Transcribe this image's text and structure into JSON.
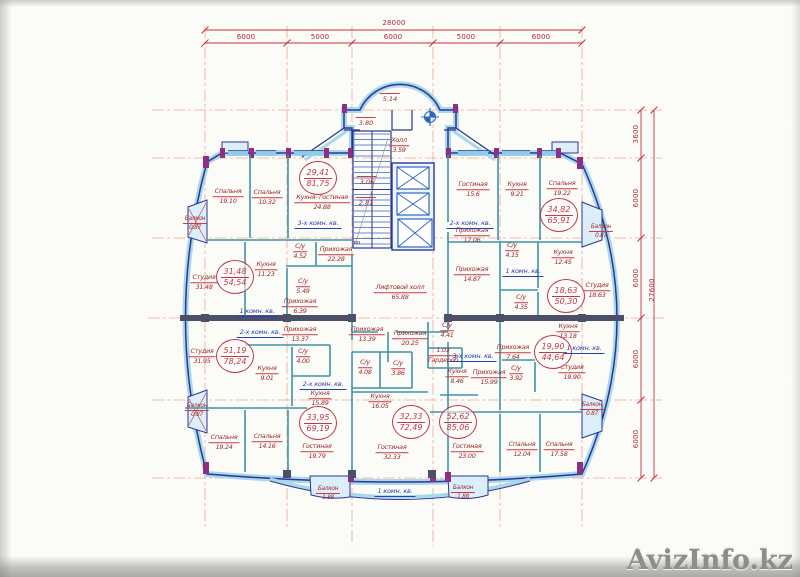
{
  "watermark": "AvizInfo.kz",
  "dimensions": {
    "top_total": {
      "text": "28000",
      "x": 394,
      "y": 23
    },
    "top_segments": [
      {
        "text": "6000",
        "x": 246,
        "y": 37
      },
      {
        "text": "5000",
        "x": 320,
        "y": 37
      },
      {
        "text": "6000",
        "x": 393,
        "y": 37
      },
      {
        "text": "5000",
        "x": 466,
        "y": 37
      },
      {
        "text": "6000",
        "x": 541,
        "y": 37
      }
    ],
    "right_total": {
      "text": "27600",
      "x": 652,
      "y": 290
    },
    "right_segments": [
      {
        "text": "3600",
        "x": 636,
        "y": 134
      },
      {
        "text": "6000",
        "x": 636,
        "y": 198
      },
      {
        "text": "6000",
        "x": 636,
        "y": 278
      },
      {
        "text": "6000",
        "x": 636,
        "y": 359
      },
      {
        "text": "6000",
        "x": 636,
        "y": 439
      }
    ]
  },
  "apartments": [
    {
      "living": "29,41",
      "total": "81,75",
      "x": 318,
      "y": 178
    },
    {
      "living": "31,48",
      "total": "54,54",
      "x": 235,
      "y": 277
    },
    {
      "living": "51,19",
      "total": "78,24",
      "x": 235,
      "y": 356
    },
    {
      "living": "33,95",
      "total": "69,19",
      "x": 318,
      "y": 423
    },
    {
      "living": "32,33",
      "total": "72,49",
      "x": 411,
      "y": 422
    },
    {
      "living": "52,62",
      "total": "85,06",
      "x": 458,
      "y": 422
    },
    {
      "living": "19,90",
      "total": "44,64",
      "x": 553,
      "y": 352
    },
    {
      "living": "18,63",
      "total": "50,30",
      "x": 566,
      "y": 296
    },
    {
      "living": "34,82",
      "total": "65,91",
      "x": 559,
      "y": 215
    }
  ],
  "unit_types": [
    {
      "label": "3-х комн. кв.",
      "x": 318,
      "y": 224
    },
    {
      "label": "1 комн. кв.",
      "x": 257,
      "y": 312
    },
    {
      "label": "2-х комн. кв.",
      "x": 260,
      "y": 333
    },
    {
      "label": "2-х комн. кв.",
      "x": 323,
      "y": 385
    },
    {
      "label": "1 комн. кв.",
      "x": 395,
      "y": 492
    },
    {
      "label": "3-х комн. кв.",
      "x": 473,
      "y": 357
    },
    {
      "label": "1 комн. кв.",
      "x": 584,
      "y": 349
    },
    {
      "label": "1 комн. кв.",
      "x": 523,
      "y": 272
    },
    {
      "label": "2-х комн. кв.",
      "x": 470,
      "y": 224
    }
  ],
  "stair_numbers": [
    {
      "value": "5.14",
      "x": 390,
      "y": 98
    },
    {
      "value": "3.80",
      "x": 366,
      "y": 122
    },
    {
      "value": "3.06",
      "x": 367,
      "y": 181
    },
    {
      "value": "2.81",
      "x": 366,
      "y": 202
    }
  ],
  "misc": [
    {
      "label": "во",
      "x": 357,
      "y": 243
    }
  ],
  "rooms": [
    {
      "name": "Спальня",
      "area": "19.10",
      "x": 228,
      "y": 197
    },
    {
      "name": "Спальня",
      "area": "10.32",
      "x": 267,
      "y": 198
    },
    {
      "name": "Кухня- гостиная",
      "area": "24.88",
      "x": 322,
      "y": 203
    },
    {
      "name": "Балкон",
      "area": "0.87",
      "x": 195,
      "y": 224
    },
    {
      "name": "С/у",
      "area": "4.52",
      "x": 300,
      "y": 252
    },
    {
      "name": "Прихожая",
      "area": "22.28",
      "x": 336,
      "y": 255
    },
    {
      "name": "Студия",
      "area": "31.48",
      "x": 204,
      "y": 283
    },
    {
      "name": "Кухня",
      "area": "11.23",
      "x": 266,
      "y": 270
    },
    {
      "name": "С/у",
      "area": "5.49",
      "x": 303,
      "y": 287
    },
    {
      "name": "Прихожая",
      "area": "6.39",
      "x": 300,
      "y": 307
    },
    {
      "name": "Студия",
      "area": "31.95",
      "x": 202,
      "y": 357
    },
    {
      "name": "Прихожая",
      "area": "13.37",
      "x": 300,
      "y": 335
    },
    {
      "name": "С/у",
      "area": "4.00",
      "x": 303,
      "y": 357
    },
    {
      "name": "Кухня",
      "area": "9.01",
      "x": 267,
      "y": 374
    },
    {
      "name": "Балкон",
      "area": "0.87",
      "x": 197,
      "y": 411
    },
    {
      "name": "Спальня",
      "area": "19.24",
      "x": 224,
      "y": 443
    },
    {
      "name": "Спальня",
      "area": "14.16",
      "x": 267,
      "y": 442
    },
    {
      "name": "Кухня",
      "area": "15.89",
      "x": 320,
      "y": 399
    },
    {
      "name": "Гостиная",
      "area": "19.79",
      "x": 317,
      "y": 452
    },
    {
      "name": "Балкон",
      "area": "1.88",
      "x": 328,
      "y": 494
    },
    {
      "name": "Прихожая",
      "area": "13.39",
      "x": 367,
      "y": 335
    },
    {
      "name": "Прихожая",
      "area": "20.25",
      "x": 410,
      "y": 339
    },
    {
      "name": "С/у",
      "area": "4.08",
      "x": 365,
      "y": 368
    },
    {
      "name": "С/у",
      "area": "3.86",
      "x": 398,
      "y": 369
    },
    {
      "name": "Кухня",
      "area": "16.05",
      "x": 380,
      "y": 402
    },
    {
      "name": "Гостиная",
      "area": "32.33",
      "x": 392,
      "y": 453
    },
    {
      "name": "Балкон",
      "area": "1.88",
      "x": 463,
      "y": 493
    },
    {
      "name": "С/у",
      "area": "4.41",
      "x": 447,
      "y": 331
    },
    {
      "name": "1.03",
      "area": "Гардероб",
      "x": 443,
      "y": 356
    },
    {
      "name": "Кухня",
      "area": "8.46",
      "x": 457,
      "y": 377
    },
    {
      "name": "Прихожая",
      "area": "15.99",
      "x": 489,
      "y": 378
    },
    {
      "name": "С/у",
      "area": "3.92",
      "x": 516,
      "y": 374
    },
    {
      "name": "Гостиная",
      "area": "23.00",
      "x": 467,
      "y": 452
    },
    {
      "name": "Спальня",
      "area": "12.04",
      "x": 522,
      "y": 450
    },
    {
      "name": "Спальня",
      "area": "17.58",
      "x": 559,
      "y": 450
    },
    {
      "name": "Балкон",
      "area": "0.87",
      "x": 592,
      "y": 410
    },
    {
      "name": "Прихожая",
      "area": "7.64",
      "x": 513,
      "y": 353
    },
    {
      "name": "Студия",
      "area": "19.90",
      "x": 572,
      "y": 373
    },
    {
      "name": "Кухня",
      "area": "13.18",
      "x": 568,
      "y": 332
    },
    {
      "name": "С/у",
      "area": "4.35",
      "x": 521,
      "y": 303
    },
    {
      "name": "Прихожая",
      "area": "14.87",
      "x": 472,
      "y": 275
    },
    {
      "name": "С/у",
      "area": "4.15",
      "x": 512,
      "y": 251
    },
    {
      "name": "Студия",
      "area": "18.63",
      "x": 597,
      "y": 291
    },
    {
      "name": "Кухня",
      "area": "12.45",
      "x": 563,
      "y": 258
    },
    {
      "name": "Гостиная",
      "area": "15.6",
      "x": 473,
      "y": 190
    },
    {
      "name": "Кухня",
      "area": "9.21",
      "x": 517,
      "y": 190
    },
    {
      "name": "Спальня",
      "area": "19.22",
      "x": 562,
      "y": 189
    },
    {
      "name": "Прихожая",
      "area": "17.06",
      "x": 472,
      "y": 236
    },
    {
      "name": "Балкон",
      "area": "0.87",
      "x": 601,
      "y": 232
    },
    {
      "name": "Холл",
      "area": "3.59",
      "x": 399,
      "y": 146
    },
    {
      "name": "Лифтовой холл",
      "area": "65.88",
      "x": 400,
      "y": 293
    }
  ]
}
